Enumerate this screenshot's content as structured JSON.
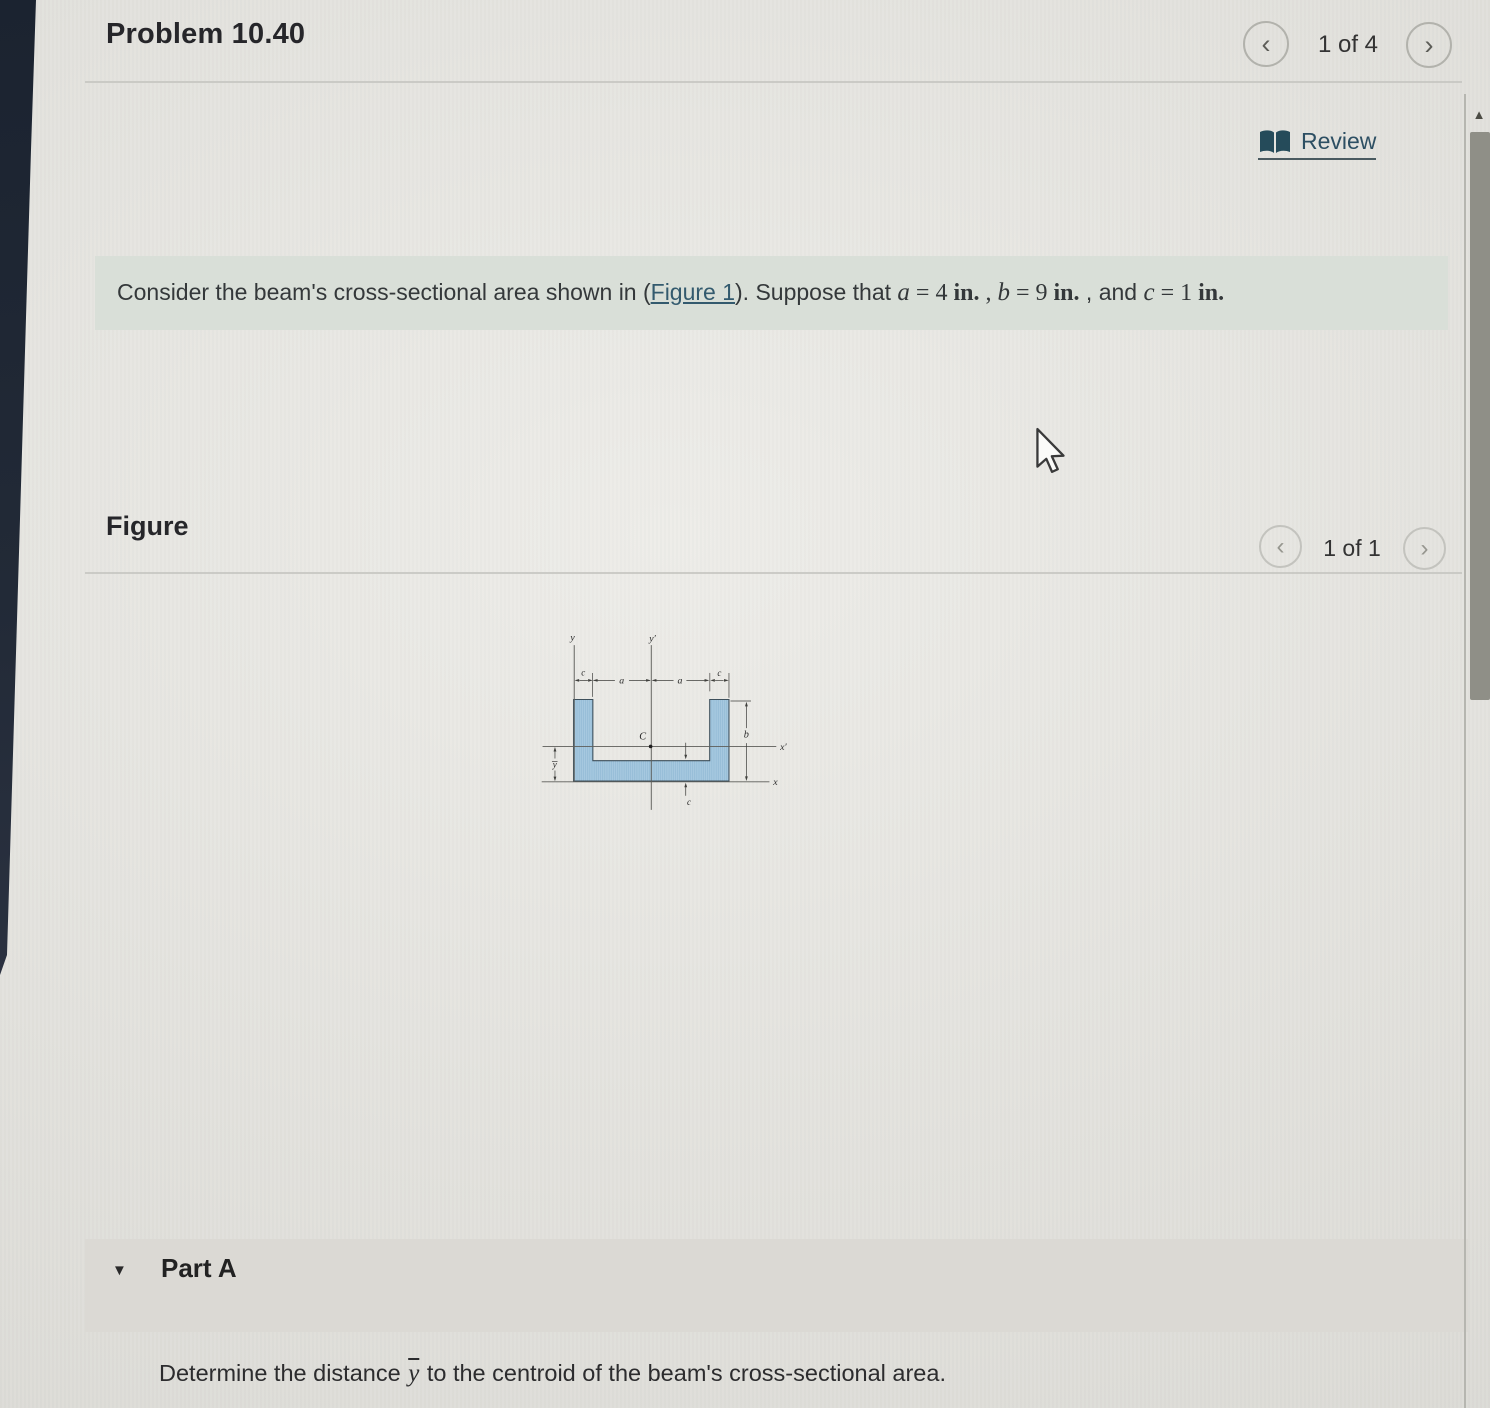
{
  "header": {
    "title": "Problem 10.40",
    "pager": {
      "current": "1 of 4"
    }
  },
  "review": {
    "label": "Review"
  },
  "statement": {
    "intro": "Consider the beam's cross-sectional area shown in (",
    "figure_link": "Figure 1",
    "after_link": "). Suppose that ",
    "terms": [
      {
        "var": "a",
        "rel": " = 4 ",
        "unit": "in."
      },
      {
        "var": "b",
        "rel": " = 9 ",
        "unit": "in."
      },
      {
        "var": "c",
        "rel": " = 1 ",
        "unit": "in."
      }
    ],
    "sep1": " , ",
    "sep2": " , and "
  },
  "figure_section": {
    "heading": "Figure",
    "pager": {
      "current": "1 of 1"
    }
  },
  "figure": {
    "labels": {
      "y": "y",
      "y_prime": "y′",
      "x": "x",
      "x_prime": "x′",
      "a": "a",
      "b": "b",
      "c": "c",
      "centroid": "C",
      "ybar": "y"
    },
    "colors": {
      "shape_fill": "#a7c9e0",
      "shape_hatch": "#8db6d2",
      "shape_outline": "#3d4f5b",
      "axis": "#5d5d59",
      "dimension": "#3f3f3c"
    }
  },
  "part_a": {
    "label": "Part A",
    "question_before": "Determine the distance ",
    "ybar": "y",
    "question_after": " to the centroid of the beam's cross-sectional area."
  },
  "icons": {
    "chevron_left": "‹",
    "chevron_right": "›",
    "triangle_down": "▼",
    "scroll_up": "▲"
  },
  "link_color": "#2d4f63"
}
